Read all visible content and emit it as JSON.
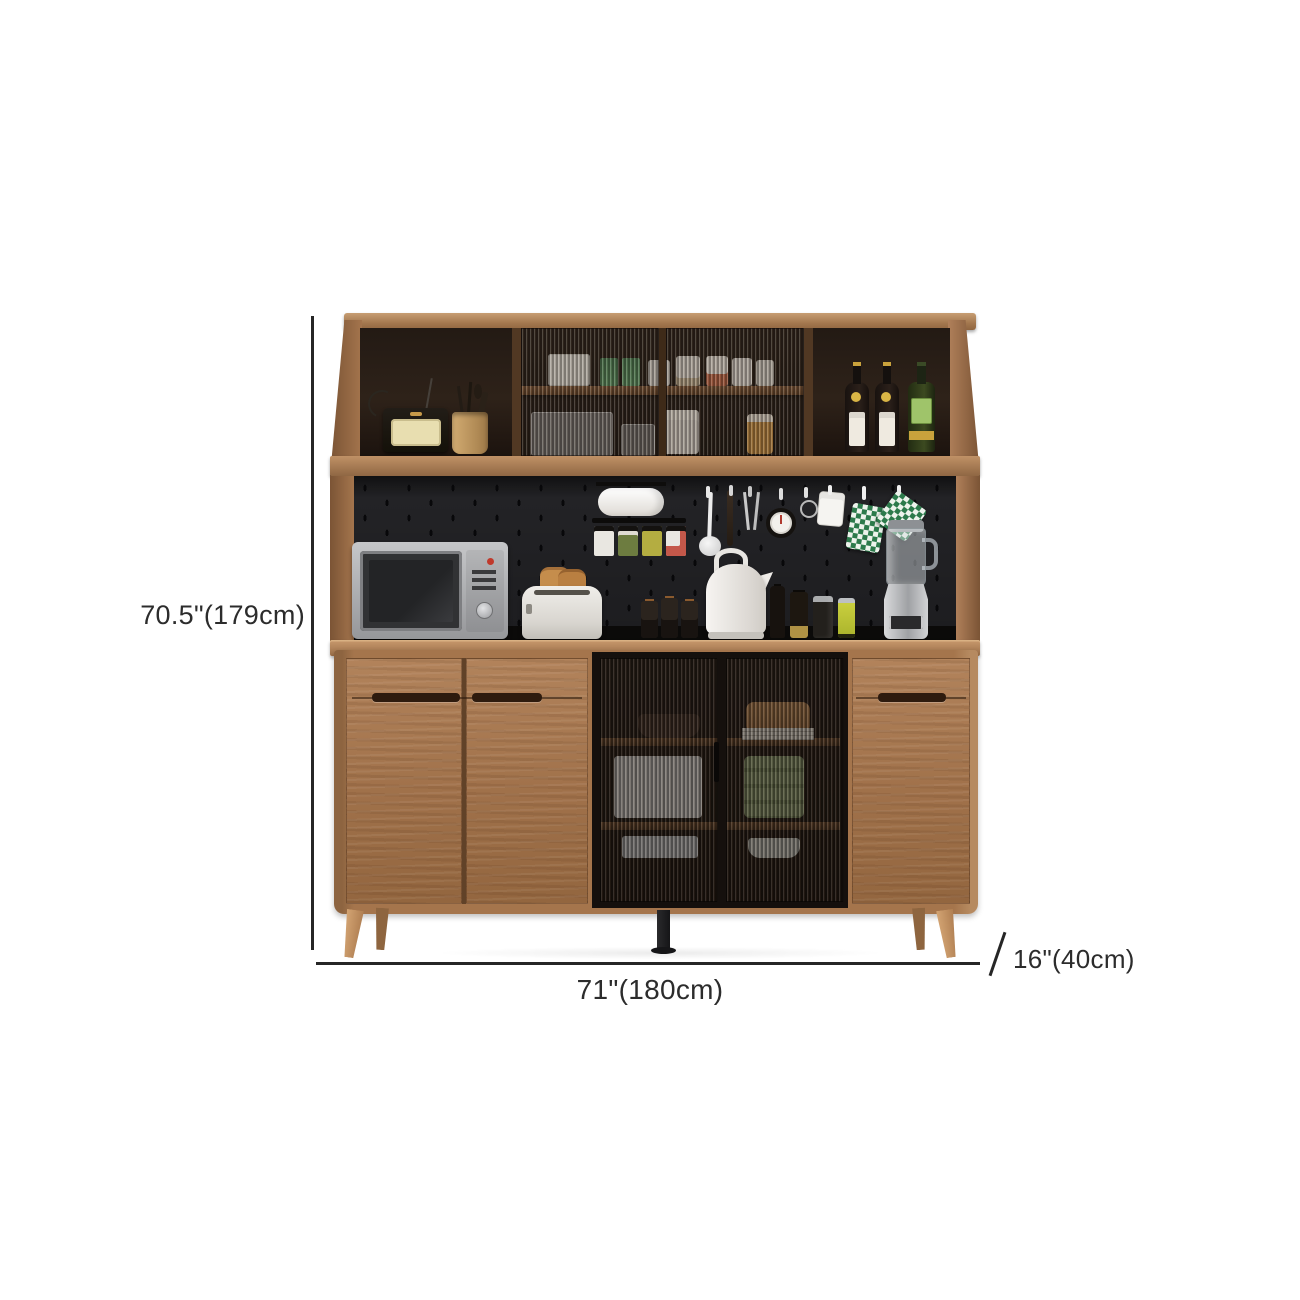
{
  "dimensions": {
    "height_label": "70.5\"(179cm)",
    "width_label": "71\"(180cm)",
    "depth_label": "16\"(40cm)"
  },
  "colors": {
    "background": "#ffffff",
    "annotation_line": "#262626",
    "annotation_text": "#2c2c2c",
    "wood_light": "#c79e73",
    "wood_mid": "#a5754c",
    "wood_dark": "#7b5435",
    "hutch_interior": "#241a14",
    "pegboard": "#1d1d20",
    "countertop": "#0b0a09",
    "glass_tint": "rgba(44,33,25,0.32)",
    "leg_wood": "#c99a6b",
    "center_leg": "#1c1c1e",
    "checker_green": "#2c7a4b"
  },
  "scene_items": [
    "vintage-radio",
    "utensil-cup",
    "wine-bottles",
    "liquor-bottle",
    "glass-display-hutch",
    "paper-towel-roll",
    "spice-jar-rack",
    "ladle",
    "spatula",
    "hanging-hooks",
    "kitchen-timer",
    "pot-holders",
    "microwave",
    "toaster",
    "spice-bottles",
    "electric-kettle",
    "oil-bottles",
    "beverage-cans",
    "blender",
    "fluted-glass-doors",
    "wood-cabinet-doors",
    "tapered-legs"
  ]
}
